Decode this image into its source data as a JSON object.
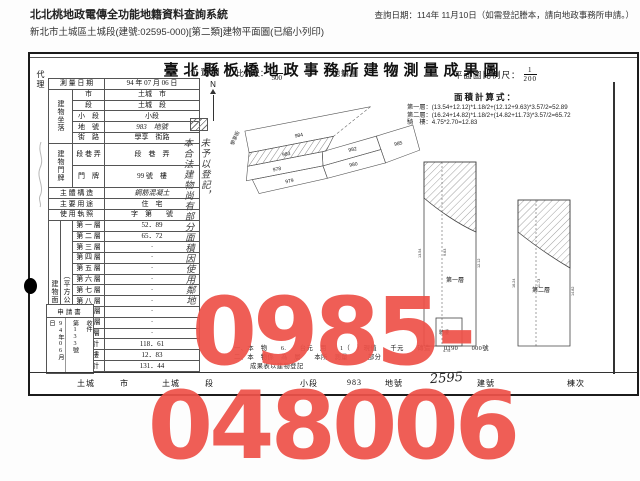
{
  "app": {
    "title": "北北桃地政電傳全功能地籍資料查詢系統",
    "subtitle": "新北市土城區土城段(建號:02595-000)[第二類]建物平面圖(已縮小列印)",
    "query_date": "查詢日期：114年 11月10日（如需登記謄本，請向地政事務所申請。）"
  },
  "doc": {
    "title": "臺北縣板橋地政事務所建物測量成果圖",
    "agent_label": "代理",
    "table": {
      "survey_label": "測 量 日 期",
      "survey_value": "94 年 07 月 06 日",
      "location_spanner": "建物坐落",
      "city_label": "市",
      "city_value": "土城　市",
      "sec_label": "段",
      "sec_value": "土城　段",
      "subsec_label": "小　段",
      "subsec_value": "小段",
      "parcel_label": "地　號",
      "parcel_value": "983　地號",
      "street_label": "街　路",
      "street_value": "學享　街路",
      "door_spanner": "建物門牌",
      "lane_label": "段 巷 弄",
      "lane_value": "段　巷　弄",
      "plate_label": "門　牌",
      "plate_value": "99 號　樓",
      "structure_label": "主 體 構 造",
      "structure_value": "鋼筋混凝土",
      "use_label": "主 要 用 途",
      "use_value": "住　宅",
      "license_label": "使 用 執 照",
      "license_value": "字　第　　號",
      "area_spanner1": "建物面積",
      "area_spanner2": "（平方公尺）",
      "floors": [
        {
          "label": "第 一 層",
          "value": "52．89"
        },
        {
          "label": "第 二 層",
          "value": "65．72"
        },
        {
          "label": "第 三 層",
          "value": "·"
        },
        {
          "label": "第 四 層",
          "value": "·"
        },
        {
          "label": "第 五 層",
          "value": "·"
        },
        {
          "label": "第 六 層",
          "value": "·"
        },
        {
          "label": "第 七 層",
          "value": "·"
        },
        {
          "label": "第 八 層",
          "value": "·"
        },
        {
          "label": "第 九 層",
          "value": "·"
        },
        {
          "label": "第 十 層",
          "value": "·"
        },
        {
          "label": "第　 層",
          "value": "·"
        },
        {
          "label": "合　計",
          "value": "118．61"
        },
        {
          "label": "騎　樓",
          "value": "12．83"
        },
        {
          "label": "合　計",
          "value": "131．44"
        }
      ],
      "application": {
        "title": "申請書",
        "date": "94年06月　日",
        "number": "第133號",
        "received": "收件"
      }
    },
    "map": {
      "section_label": "位置圖",
      "scale_label": "比例尺：",
      "scale_num": "1",
      "scale_den": "500",
      "cadastre_label": "地籍圖",
      "sheet_label": "號",
      "north_label": "N",
      "street": "學享街",
      "parcels": [
        "984",
        "983",
        "978",
        "982",
        "979",
        "980",
        "985"
      ],
      "note_col_right": "未予以登記，",
      "note_col_left": "本合法建物尚有部分面積因使用鄰地"
    },
    "plan": {
      "scale_label": "平面圖比例尺：",
      "scale_num": "1",
      "scale_den": "200",
      "calc_label": "面積計算式：",
      "formulas": [
        "第一層：(13.54+12.12)*1.18/2+(12.12+9.63)*3.57/2=52.89",
        "第二層：(16.24+14.82)*1.18/2+(14.82+11.73)*3.57/2=65.72",
        "騎　樓：4.75*2.70=12.83"
      ],
      "floor1_label": "第一層",
      "floor2_label": "第二層",
      "arcade_label": "騎樓",
      "dims_floor1": [
        "13.54",
        "9.63",
        "12.12"
      ],
      "dims_floor2": [
        "16.24",
        "11.73",
        "14.82"
      ],
      "dim_arcade": "4.75"
    },
    "notes": [
      "一、本　物　　6.　　台元　用　　1（　）現值　　千元　　磚造　　0190　　000號",
      "二、本　物係　為　層　　本所　測量　　　部分",
      "成果表以建物登記"
    ],
    "footer": [
      "土城",
      "市",
      "土城",
      "段",
      "小段",
      "983",
      "地號",
      "2595",
      "建號",
      "棟次"
    ],
    "watermark": "0985-048006"
  }
}
